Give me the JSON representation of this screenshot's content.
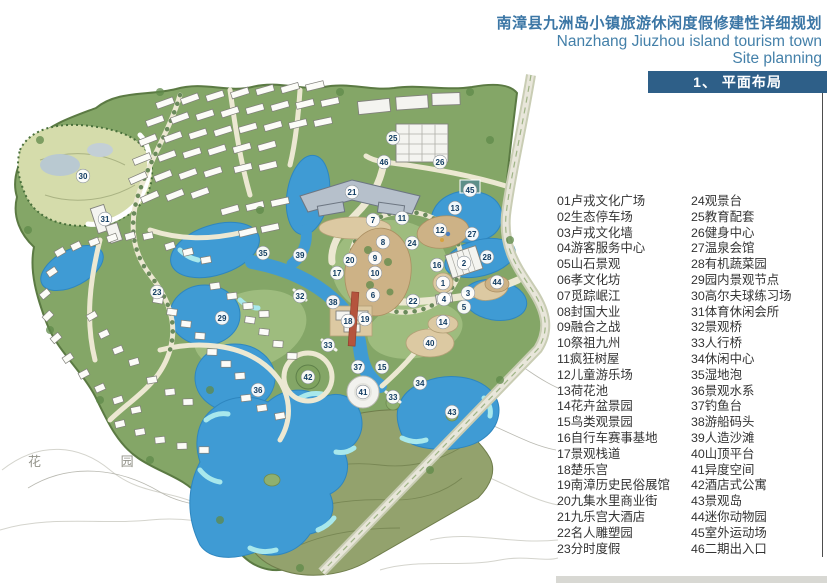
{
  "header": {
    "title_cn": "南漳县九洲岛小镇旅游休闲度假修建性详细规划",
    "title_en_line1": "Nanzhang Jiuzhou island tourism town",
    "title_en_line2": "Site planning",
    "section_label": "1、 平面布局"
  },
  "legend": {
    "column1": [
      "01卢戎文化广场",
      "02生态停车场",
      "03卢戎文化墙",
      "04游客服务中心",
      "05山石景观",
      "06孝文化坊",
      "07觅踪岷江",
      "08封国大业",
      "09融合之战",
      "10祭祖九州",
      "11疯狂树屋",
      "12儿童游乐场",
      "13荷花池",
      "14花卉盆景园",
      "15鸟类观景园",
      "16自行车赛事基地",
      "17景观栈道",
      "18楚乐宫",
      "19南漳历史民俗展馆",
      "20九集水里商业街",
      "21九乐宫大酒店",
      "22名人雕塑园",
      "23分时度假"
    ],
    "column2": [
      "24观景台",
      "25教育配套",
      "26健身中心",
      "27温泉会馆",
      "28有机蔬菜园",
      "29园内景观节点",
      "30高尔夫球练习场",
      "31体育休闲会所",
      "32景观桥",
      "33人行桥",
      "34休闲中心",
      "35湿地泡",
      "36景观水系",
      "37钓鱼台",
      "38游船码头",
      "39人造沙滩",
      "40山顶平台",
      "41异度空间",
      "42酒店式公寓",
      "43景观岛",
      "44迷你动物园",
      "45室外运动场",
      "46二期出入口"
    ]
  },
  "map": {
    "village_label": "花 园 村",
    "markers": [
      {
        "n": "30",
        "x": 83,
        "y": 176
      },
      {
        "n": "31",
        "x": 105,
        "y": 219
      },
      {
        "n": "23",
        "x": 157,
        "y": 292
      },
      {
        "n": "21",
        "x": 352,
        "y": 192
      },
      {
        "n": "25",
        "x": 393,
        "y": 138
      },
      {
        "n": "46",
        "x": 384,
        "y": 162
      },
      {
        "n": "26",
        "x": 440,
        "y": 162
      },
      {
        "n": "45",
        "x": 470,
        "y": 190
      },
      {
        "n": "13",
        "x": 455,
        "y": 208
      },
      {
        "n": "11",
        "x": 402,
        "y": 218
      },
      {
        "n": "7",
        "x": 373,
        "y": 220
      },
      {
        "n": "12",
        "x": 440,
        "y": 230
      },
      {
        "n": "8",
        "x": 383,
        "y": 242
      },
      {
        "n": "24",
        "x": 412,
        "y": 243
      },
      {
        "n": "9",
        "x": 375,
        "y": 258
      },
      {
        "n": "10",
        "x": 375,
        "y": 273
      },
      {
        "n": "6",
        "x": 373,
        "y": 295
      },
      {
        "n": "27",
        "x": 472,
        "y": 234
      },
      {
        "n": "28",
        "x": 487,
        "y": 257
      },
      {
        "n": "2",
        "x": 464,
        "y": 263
      },
      {
        "n": "16",
        "x": 437,
        "y": 265
      },
      {
        "n": "1",
        "x": 443,
        "y": 283
      },
      {
        "n": "3",
        "x": 468,
        "y": 293
      },
      {
        "n": "4",
        "x": 444,
        "y": 299
      },
      {
        "n": "5",
        "x": 464,
        "y": 307
      },
      {
        "n": "22",
        "x": 413,
        "y": 301
      },
      {
        "n": "44",
        "x": 497,
        "y": 282
      },
      {
        "n": "14",
        "x": 443,
        "y": 322
      },
      {
        "n": "40",
        "x": 430,
        "y": 343
      },
      {
        "n": "35",
        "x": 263,
        "y": 253
      },
      {
        "n": "39",
        "x": 300,
        "y": 255
      },
      {
        "n": "20",
        "x": 350,
        "y": 260
      },
      {
        "n": "17",
        "x": 337,
        "y": 273
      },
      {
        "n": "32",
        "x": 300,
        "y": 296
      },
      {
        "n": "38",
        "x": 333,
        "y": 302
      },
      {
        "n": "18",
        "x": 348,
        "y": 321
      },
      {
        "n": "19",
        "x": 365,
        "y": 319
      },
      {
        "n": "29",
        "x": 222,
        "y": 318
      },
      {
        "n": "33",
        "x": 328,
        "y": 345
      },
      {
        "n": "37",
        "x": 358,
        "y": 367
      },
      {
        "n": "15",
        "x": 382,
        "y": 367
      },
      {
        "n": "42",
        "x": 308,
        "y": 377
      },
      {
        "n": "41",
        "x": 363,
        "y": 392
      },
      {
        "n": "33",
        "x": 393,
        "y": 397
      },
      {
        "n": "36",
        "x": 258,
        "y": 390
      },
      {
        "n": "34",
        "x": 420,
        "y": 383
      },
      {
        "n": "43",
        "x": 452,
        "y": 412
      }
    ]
  },
  "colors": {
    "section_bar_blue": "#2e5f88",
    "title_blue": "#3b76a5",
    "legend_text": "#333333",
    "site_green": "#84a667",
    "water_blue": "#3f9bd4",
    "hill_olive": "#93a26d",
    "road_cream": "#ece8d2"
  }
}
